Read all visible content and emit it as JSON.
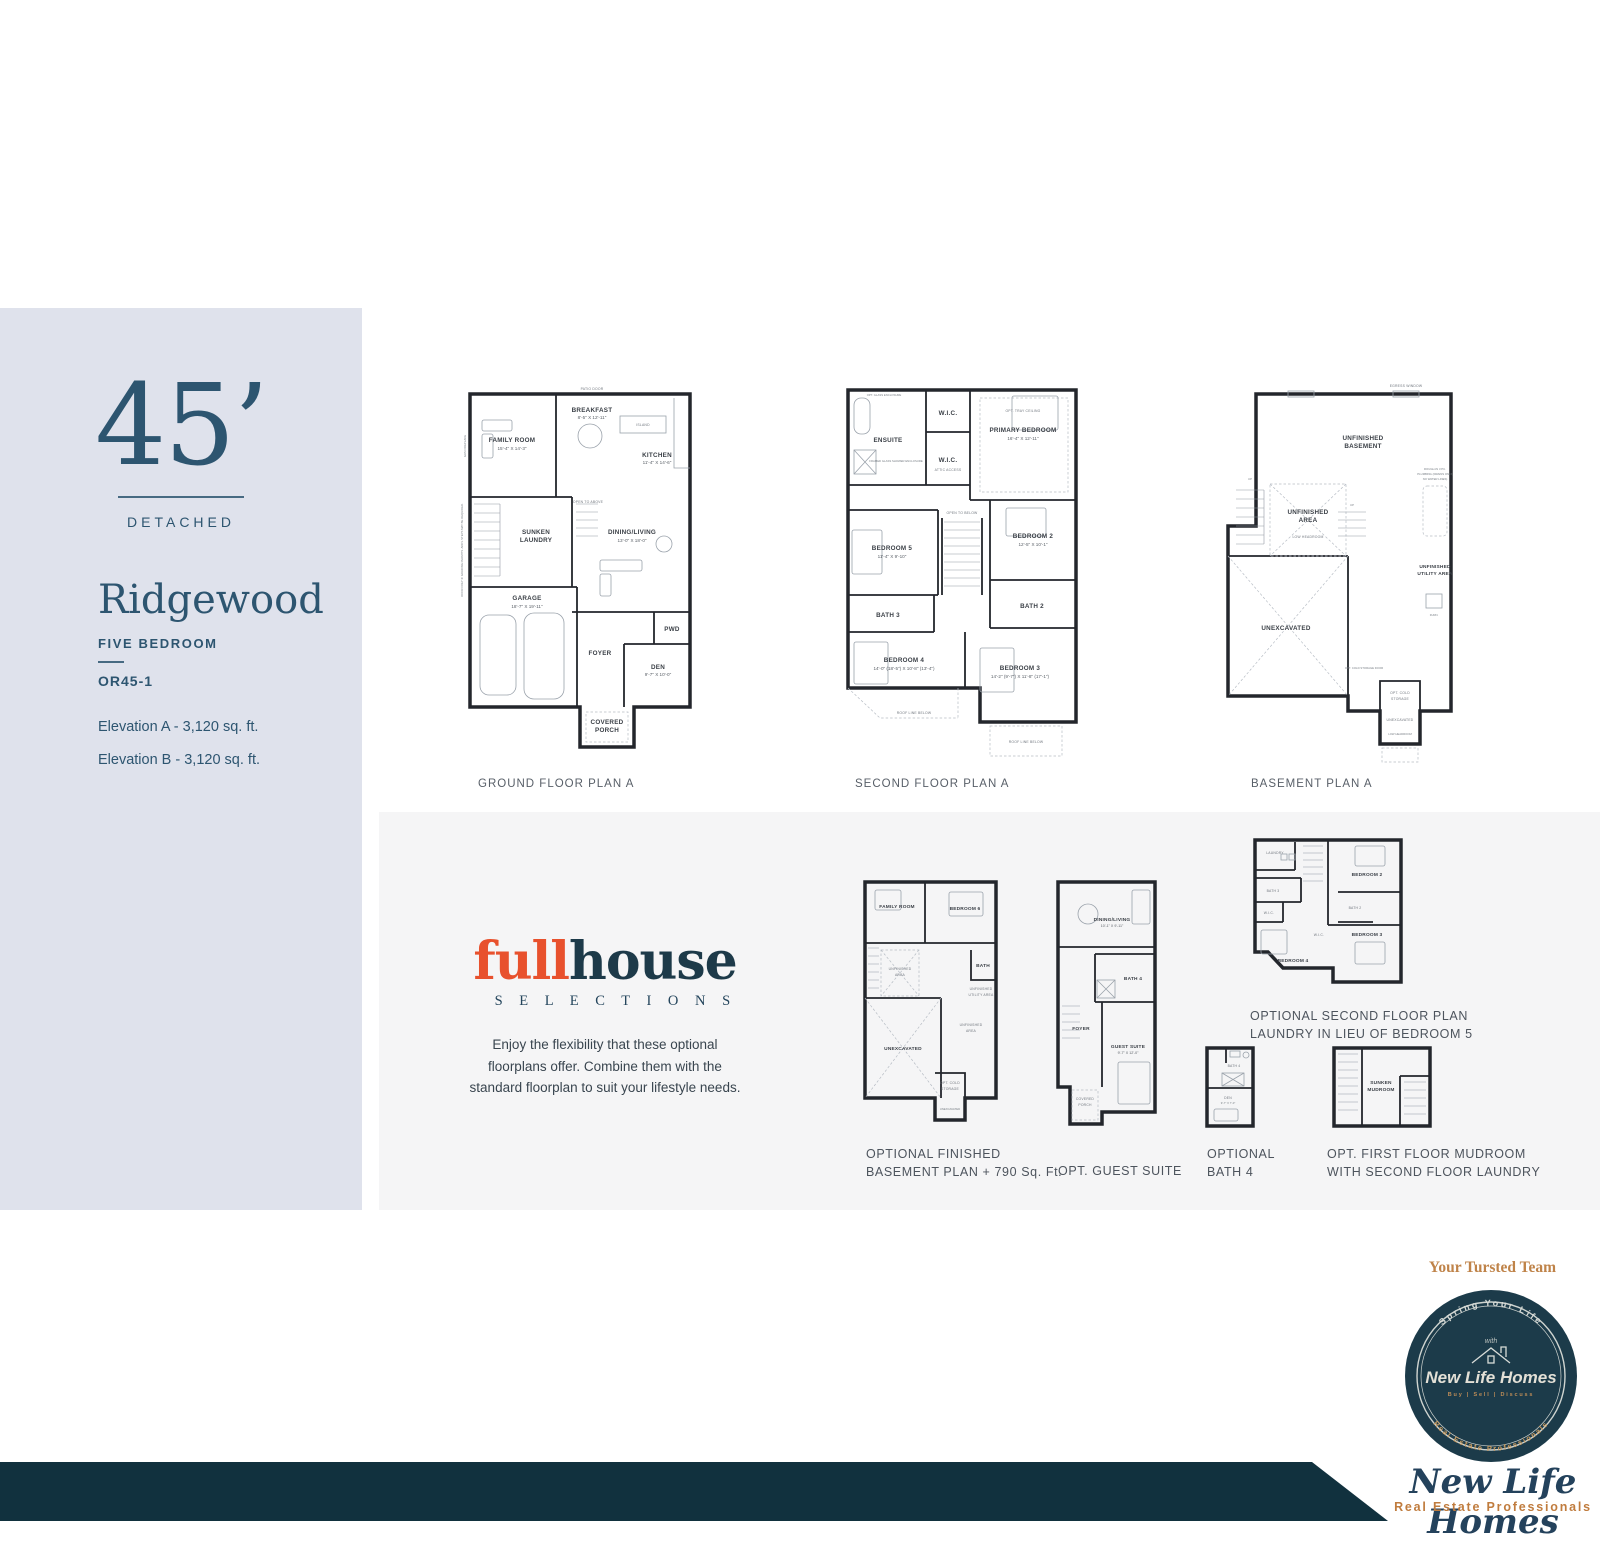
{
  "sidebar": {
    "lot_width": "45’",
    "type_label": "DETACHED",
    "model_name": "Ridgewood",
    "bedrooms_label": "FIVE BEDROOM",
    "model_code": "OR45-1",
    "elevation_a": "Elevation A - 3,120 sq. ft.",
    "elevation_b": "Elevation B - 3,120 sq. ft."
  },
  "plans": {
    "ground": {
      "caption": "GROUND FLOOR PLAN A",
      "rooms": {
        "family": {
          "name": "FAMILY ROOM",
          "dim": "15'-4\" X 14'-3\""
        },
        "breakfast": {
          "name": "BREAKFAST",
          "dim": "8'-5\" X 12'-11\""
        },
        "kitchen": {
          "name": "KITCHEN",
          "dim": "11'-4\" X 14'-6\""
        },
        "island": "ISLAND",
        "laundry": {
          "line1": "SUNKEN",
          "line2": "LAUNDRY"
        },
        "dining": {
          "name": "DINING/LIVING",
          "dim": "13'-0\" X 18'-0\""
        },
        "garage": {
          "name": "GARAGE",
          "dim": "18'-7\" X 19'-11\""
        },
        "foyer": "FOYER",
        "pwd": "PWD",
        "den": {
          "name": "DEN",
          "dim": "9'-7\" X 10'-0\""
        },
        "porch": {
          "line1": "COVERED",
          "line2": "PORCH"
        }
      },
      "notes": {
        "patio_door": "PATIO DOOR",
        "open_above": "OPEN TO ABOVE",
        "fireplace": "GAS FIREPLACE",
        "grading": "DOOR ONLY IF GRADING PERMITS. ADD'L STEPS MAY BE REQUIRED."
      }
    },
    "second": {
      "caption": "SECOND FLOOR PLAN A",
      "rooms": {
        "ensuite": "ENSUITE",
        "wic1": "W.I.C.",
        "wic2": "W.I.C.",
        "primary": {
          "name": "PRIMARY BEDROOM",
          "dim": "16'-4\" X 12'-11\""
        },
        "bed5": {
          "name": "BEDROOM 5",
          "dim": "11'-4\" X 9'-10\""
        },
        "bed2": {
          "name": "BEDROOM 2",
          "dim": "12'-5\" X 10'-1\""
        },
        "bath3": "BATH 3",
        "bath2": "BATH 2",
        "bed4": {
          "name": "BEDROOM 4",
          "dim": "14'-0\" (18'-5\") X 10'-8\" (13'-4\")"
        },
        "bed3": {
          "name": "BEDROOM 3",
          "dim": "14'-2\" (9'-7\") X 11'-8\" (17'-1\")"
        }
      },
      "notes": {
        "tray": "OPT. TRAY CEILING",
        "attic": "ATTIC ACCESS",
        "open_below": "OPEN TO BELOW",
        "roof1": "ROOF LINE BELOW",
        "roof2": "ROOF LINE BELOW",
        "glass": "OPT. GLASS ENCLOSURE",
        "shower": "FRAMED GLASS SHOWER ENCLOSURE"
      }
    },
    "basement": {
      "caption": "BASEMENT PLAN A",
      "rooms": {
        "unfinished": {
          "line1": "UNFINISHED",
          "line2": "BASEMENT"
        },
        "unf_area": {
          "line1": "UNFINISHED",
          "line2": "AREA",
          "note": "LOW HEADROOM"
        },
        "unexcavated": "UNEXCAVATED",
        "utility": {
          "line1": "UNFINISHED",
          "line2": "UTILITY AREA"
        },
        "cold": {
          "line1": "OPT. COLD",
          "line2": "STORAGE"
        },
        "unex2": "UNEXCAVATED",
        "low2": "LOW HEADROOM"
      },
      "notes": {
        "egress": "EGRESS WINDOW",
        "roughin1": "ROUGH-IN 3 PC.",
        "roughin2": "PLUMBING (DRAINS ONLY,",
        "roughin3": "NO WATER LINES)",
        "cold_door": "OPT. COLD STORAGE DOOR",
        "furn": "FURN.",
        "up1": "UP",
        "up2": "UP"
      }
    }
  },
  "fullhouse": {
    "logo_part1": "full",
    "logo_part2": "house",
    "logo_sub": "S E L E C T I O N S",
    "desc_line1": "Enjoy the flexibility that these optional",
    "desc_line2": "floorplans offer. Combine them with the",
    "desc_line3": "standard floorplan to suit your lifestyle needs."
  },
  "optional_plans": {
    "basement": {
      "caption1": "OPTIONAL FINISHED",
      "caption2": "BASEMENT PLAN  + 790 Sq. Ft.",
      "rooms": {
        "family": "FAMILY ROOM",
        "bed6": "BEDROOM 6",
        "unf1a": "UNFINISHED",
        "unf1b": "AREA",
        "bath": "BATH",
        "util1": "UNFINISHED",
        "util2": "UTILITY AREA",
        "unex": "UNEXCAVATED",
        "unf2a": "UNFINISHED",
        "unf2b": "AREA",
        "cold1": "OPT. COLD",
        "cold2": "STORAGE",
        "unex2": "UNEXCAVATED"
      }
    },
    "guest": {
      "caption1": "OPT. GUEST SUITE",
      "rooms": {
        "dining": {
          "name": "DINING/LIVING",
          "dim": "10'-1\" X 9'-11\""
        },
        "bath4": "BATH 4",
        "foyer": "FOYER",
        "guest": {
          "name": "GUEST SUITE",
          "dim": "9'-7\" X 12'-0\""
        },
        "porch1": "COVERED",
        "porch2": "PORCH"
      }
    },
    "second": {
      "caption1": "OPTIONAL SECOND FLOOR PLAN",
      "caption2": "LAUNDRY IN LIEU OF BEDROOM 5",
      "rooms": {
        "laundry": "LAUNDRY",
        "bath3": "BATH 3",
        "wic1": "W.I.C.",
        "bed4": "BEDROOM 4",
        "wic2": "W.I.C.",
        "bed2": "BEDROOM 2",
        "bath2": "BATH 2",
        "bed3": "BEDROOM 3"
      }
    },
    "bath4": {
      "caption1": "OPTIONAL",
      "caption2": "BATH 4",
      "rooms": {
        "bath4": "BATH 4",
        "den": {
          "name": "DEN",
          "dim": "9'-7\" X 7'-0\""
        }
      }
    },
    "mudroom": {
      "caption1": "OPT. FIRST FLOOR MUDROOM",
      "caption2": "WITH SECOND FLOOR LAUNDRY",
      "rooms": {
        "line1": "SUNKEN",
        "line2": "MUDROOM"
      }
    }
  },
  "branding": {
    "trusted_team": "Your Tursted Team",
    "badge": {
      "arc_top": "Spring Your Life",
      "with_word": "with",
      "name": "New Life Homes",
      "services": "Buy | Sell | Discuss",
      "arc_bottom": "Real Estate Professionals"
    },
    "signature_name": "New Life Homes",
    "signature_tagline": "Real Estate Professionals"
  },
  "colors": {
    "sidebar_bg": "#dfe2ec",
    "section_bg": "#f5f5f6",
    "navy_text": "#2d5570",
    "caption_gray": "#585f68",
    "logo_orange": "#e8512d",
    "logo_navy": "#1d3a49",
    "footer_navy": "#11313e",
    "badge_navy": "#1c3b4a",
    "brand_tan": "#bf8349"
  }
}
